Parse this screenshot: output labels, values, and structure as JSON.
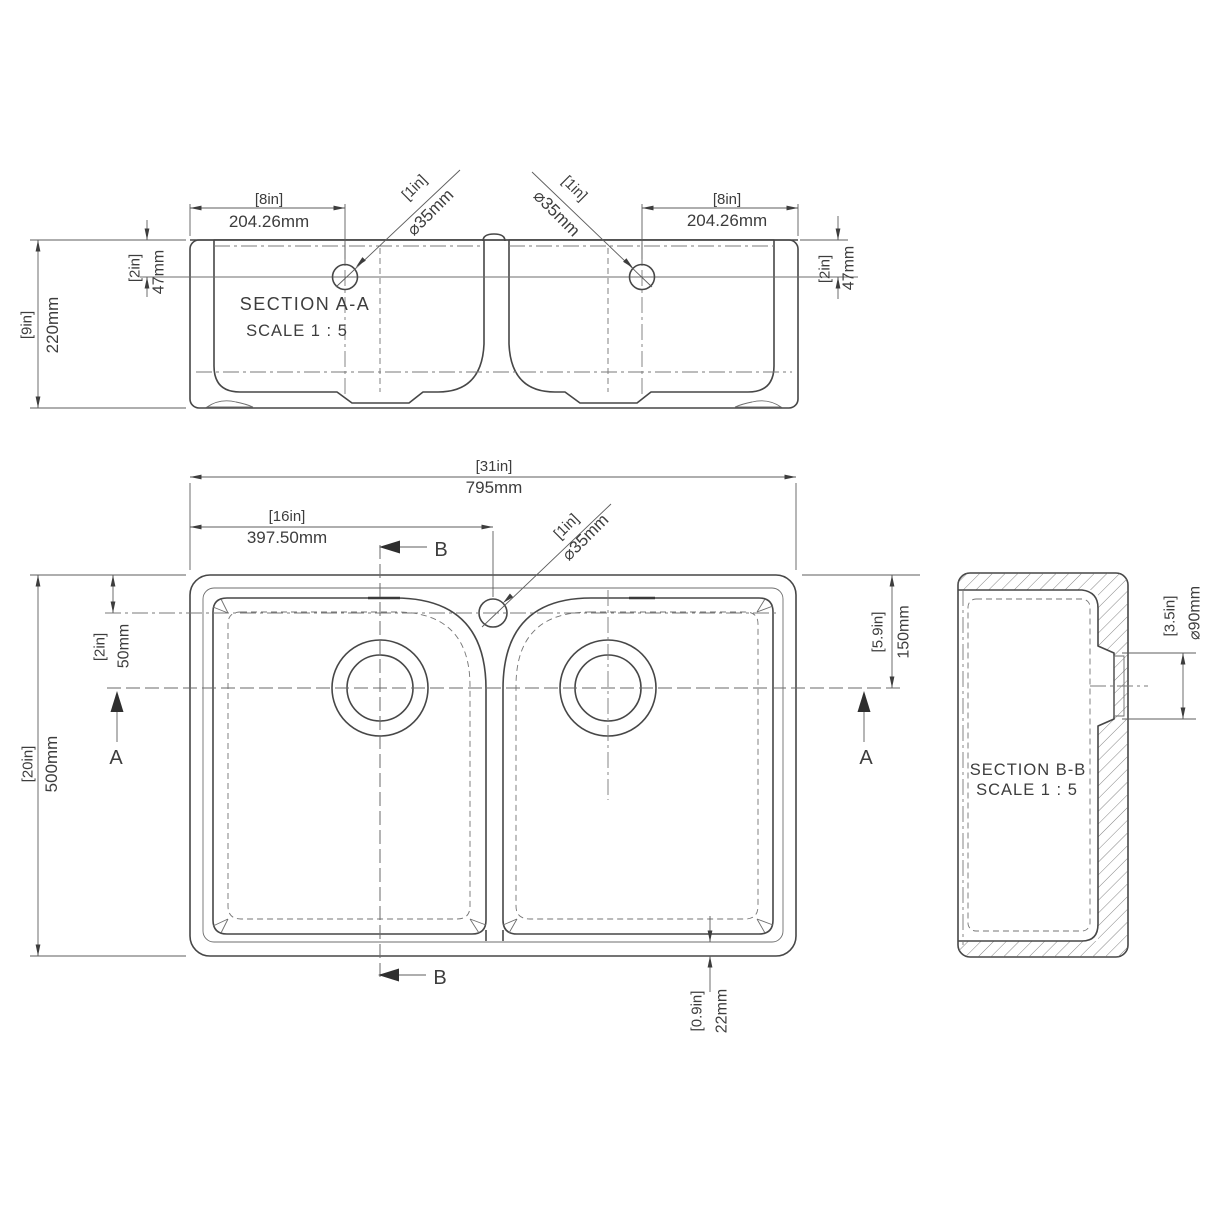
{
  "section_aa": {
    "title": "SECTION A-A",
    "scale": "SCALE 1 : 5",
    "hole_offset_x_in": "[8in]",
    "hole_offset_x_mm": "204.26mm",
    "hole_dia_in": "[1in]",
    "hole_dia_mm": "⌀35mm",
    "overall_height_in": "[9in]",
    "overall_height_mm": "220mm",
    "hole_offset_y_in": "[2in]",
    "hole_offset_y_mm": "47mm"
  },
  "plan_view": {
    "overall_width_in": "[31in]",
    "overall_width_mm": "795mm",
    "centre_offset_in": "[16in]",
    "centre_offset_mm": "397.50mm",
    "overall_depth_in": "[20in]",
    "overall_depth_mm": "500mm",
    "tap_hole_offset_in": "[2in]",
    "tap_hole_offset_mm": "50mm",
    "waste_offset_in": "[5.9in]",
    "waste_offset_mm": "150mm",
    "rim_thickness_in": "[0.9in]",
    "rim_thickness_mm": "22mm",
    "tap_hole_dia_in": "[1in]",
    "tap_hole_dia_mm": "⌀35mm",
    "cut_label_a": "A",
    "cut_label_b": "B"
  },
  "section_bb": {
    "title": "SECTION B-B",
    "scale": "SCALE 1 : 5",
    "waste_dia_in": "[3.5in]",
    "waste_dia_mm": "⌀90mm"
  }
}
